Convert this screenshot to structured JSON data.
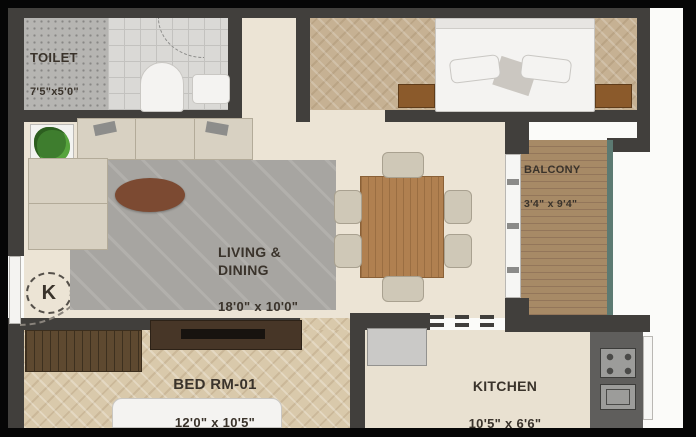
{
  "title": "apartment-floor-plan",
  "rooms": {
    "toilet": {
      "name": "TOILET",
      "dims": "7'5\"x5'0\""
    },
    "living": {
      "name": "LIVING &\nDINING",
      "dims": "18'0\" x 10'0\""
    },
    "balcony": {
      "name": "BALCONY",
      "dims": "3'4\" x 9'4\""
    },
    "bedroom1": {
      "name": "BED RM-01",
      "dims": "12'0\" x 10'5\""
    },
    "kitchen": {
      "name": "KITCHEN",
      "dims": "10'5\" x 6'6\""
    }
  },
  "markers": {
    "entrance_door": "K"
  },
  "colors": {
    "frame": "#060606",
    "exterior": "#fbfbf9",
    "wall": "#413f3c",
    "ink": "#3a332b",
    "floor-living": "#ece4d5",
    "floor-kitchen": "#e9e1d1",
    "floor-bed1": "#d9c9ab",
    "floor-bed2": "#c6b193",
    "floor-toilet-a": "#b6b5b2",
    "floor-toilet-b": "#dad9d6",
    "balcony-wood": "#a78a66",
    "balcony-wood-dark": "#93765a",
    "glass": "#5c7a72",
    "sofa": "#d8d1c2",
    "rug": "#a7a5a1",
    "table-wood": "#b08050",
    "coffee-table": "#7c4a32",
    "dark-wood": "#5e4930",
    "console-wood": "#473627",
    "counter": "#5f5e5c",
    "fixture": "#9c9c9a",
    "fridge": "#cac9c7",
    "plant": "#3e7d2e",
    "white-furn": "#f4f3f1",
    "chair": "#cfc8b7"
  }
}
